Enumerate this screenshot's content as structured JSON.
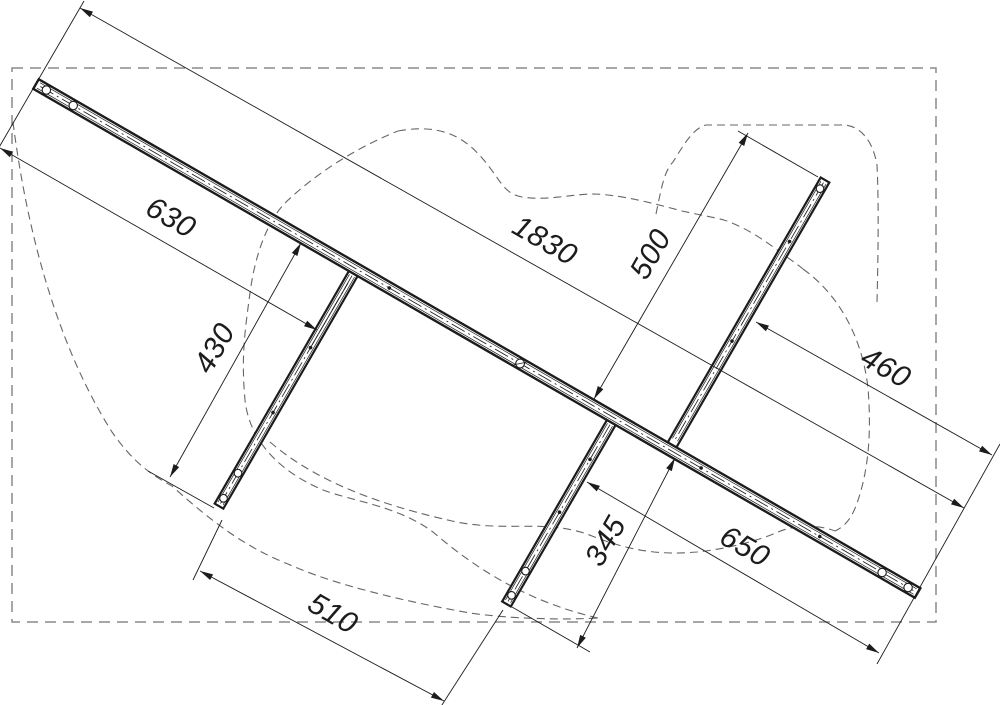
{
  "drawing": {
    "type": "frame-assembly-top-view",
    "background_color": "#ffffff",
    "line_color": "#1c1c1c",
    "silhouette_color": "#666666",
    "reference_box_color": "#8a8a8a"
  },
  "dimensions": [
    {
      "id": "dim-630",
      "label": "630"
    },
    {
      "id": "dim-1830",
      "label": "1830"
    },
    {
      "id": "dim-500",
      "label": "500"
    },
    {
      "id": "dim-430",
      "label": "430"
    },
    {
      "id": "dim-460",
      "label": "460"
    },
    {
      "id": "dim-510",
      "label": "510"
    },
    {
      "id": "dim-345",
      "label": "345"
    },
    {
      "id": "dim-650",
      "label": "650"
    }
  ]
}
